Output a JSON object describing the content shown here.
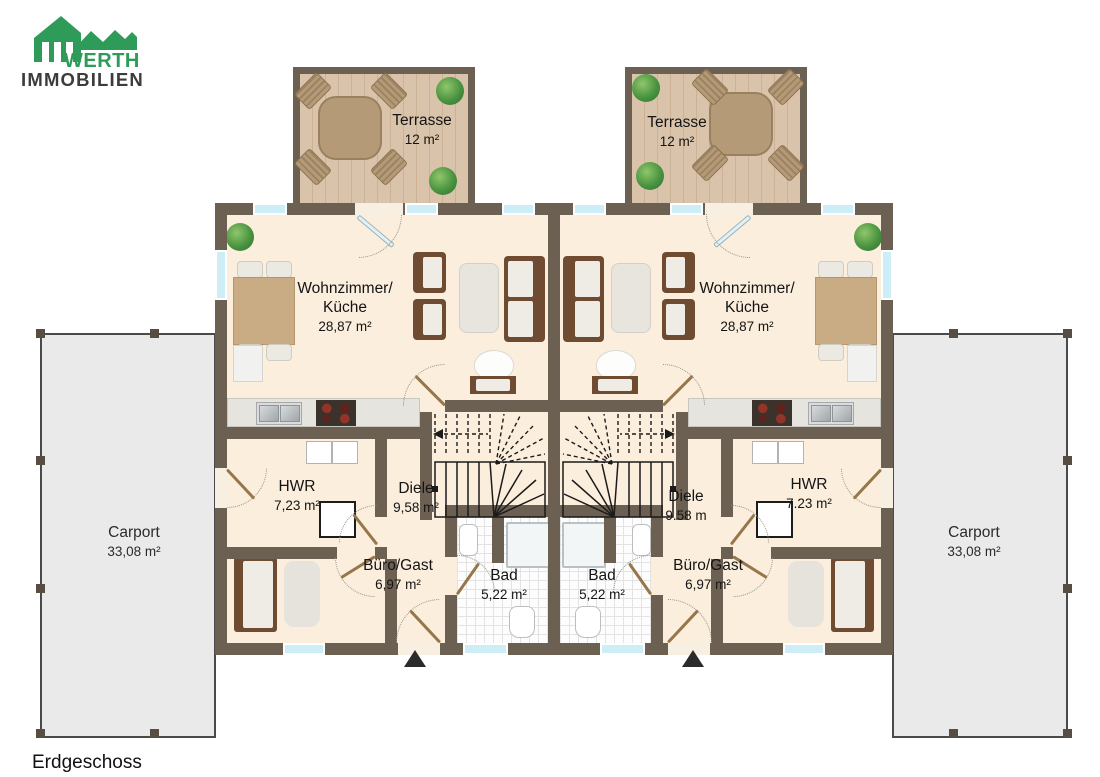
{
  "logo": {
    "line1": "WERTH",
    "line2": "IMMOBILIEN"
  },
  "floor_label": "Erdgeschoss",
  "entrance_marker": "triangle-up",
  "terraces": {
    "left": {
      "name": "Terrasse",
      "area": "12 m²"
    },
    "right": {
      "name": "Terrasse",
      "area": "12 m²"
    }
  },
  "carports": {
    "left": {
      "name": "Carport",
      "area": "33,08 m²"
    },
    "right": {
      "name": "Carport",
      "area": "33,08 m²"
    }
  },
  "units": {
    "left": {
      "living": {
        "name": "Wohnzimmer/",
        "name2": "Küche",
        "area": "28,87 m²"
      },
      "hwr": {
        "name": "HWR",
        "area": "7,23 m²"
      },
      "diele": {
        "name": "Diele",
        "area": "9,58 m²"
      },
      "buero": {
        "name": "Büro/Gast",
        "area": "6,97 m²"
      },
      "bad": {
        "name": "Bad",
        "area": "5,22 m²"
      }
    },
    "right": {
      "living": {
        "name": "Wohnzimmer/",
        "name2": "Küche",
        "area": "28,87 m²"
      },
      "hwr": {
        "name": "HWR",
        "area": "7.23 m²"
      },
      "diele": {
        "name": "Diele",
        "area": "9.58 m"
      },
      "buero": {
        "name": "Büro/Gast",
        "area": "6,97 m²"
      },
      "bad": {
        "name": "Bad",
        "area": "5,22 m²"
      }
    }
  },
  "colors": {
    "brand_green": "#2e9c58",
    "logo_text_gray": "#3c3c3c",
    "wall": "#6c6053",
    "floor": "#fbeedd",
    "terrace_wood": "#d9c3ab",
    "window_blue": "#cdeef7",
    "carport_gray": "#eaeaea"
  }
}
